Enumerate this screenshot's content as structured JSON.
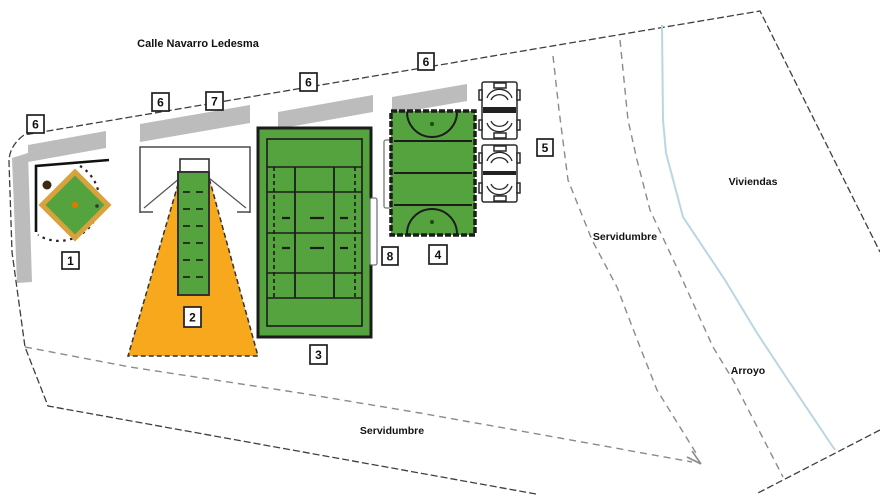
{
  "plan": {
    "street_label": "Calle Navarro Ledesma",
    "area_labels": {
      "viviendas": "Viviendas",
      "servidumbre_right": "Servidumbre",
      "servidumbre_bottom": "Servidumbre",
      "arroyo": "Arroyo"
    },
    "markers": [
      {
        "label": "6"
      },
      {
        "label": "6"
      },
      {
        "label": "7"
      },
      {
        "label": "6"
      },
      {
        "label": "6"
      },
      {
        "label": "5"
      },
      {
        "label": "8"
      },
      {
        "label": "4"
      },
      {
        "label": "1"
      },
      {
        "label": "2"
      },
      {
        "label": "3"
      }
    ],
    "colors": {
      "court_green": "#55a33e",
      "line_dark": "#1c1c1c",
      "orange": "#f7a81d",
      "diamond_border": "#d8a23c",
      "sidewalk_gray": "#bcbcbc",
      "boundary_gray": "#3f3f3f",
      "easement_gray": "#8b8b8b",
      "stream_blue": "#b9d7e2",
      "center_dot_orange": "#d97c00"
    }
  }
}
